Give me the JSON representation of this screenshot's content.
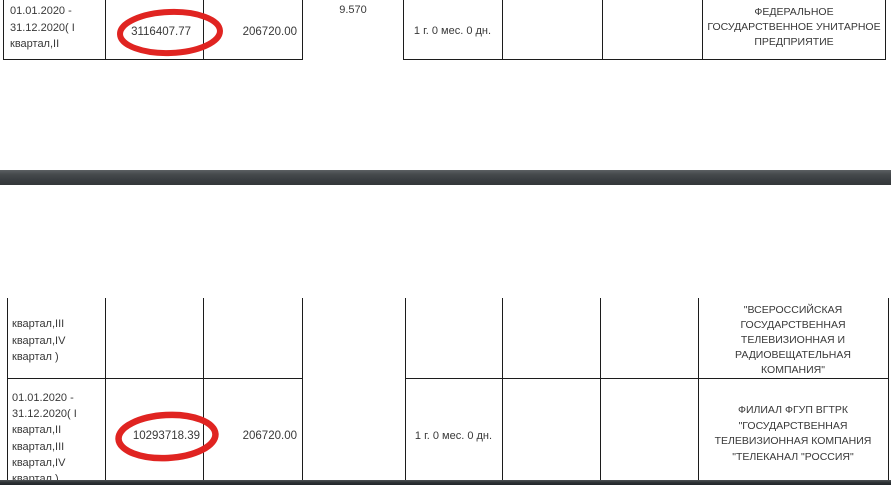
{
  "document": {
    "type": "pdf-table-fragment",
    "language": "ru"
  },
  "page1": {
    "row": {
      "period": "01.01.2020 -\n31.12.2020( I\nквартал,II",
      "max_price": "3116407.77",
      "guarantee": "206720.00",
      "rate": "9.570",
      "duration": "1 г. 0 мес. 0 дн.",
      "supplier": "ФЕДЕРАЛЬНОЕ\nГОСУДАРСТВЕННОЕ УНИТАРНОЕ\nПРЕДПРИЯТИЕ"
    }
  },
  "page2": {
    "row1": {
      "period": "квартал,III\nквартал,IV\nквартал )",
      "supplier": "\"ВСЕРОССИЙСКАЯ\nГОСУДАРСТВЕННАЯ\nТЕЛЕВИЗИОННАЯ И\nРАДИОВЕЩАТЕЛЬНАЯ\nКОМПАНИЯ\""
    },
    "row2": {
      "period": "01.01.2020 -\n31.12.2020( I\nквартал,II\nквартал,III\nквартал,IV\nквартал )",
      "max_price": "10293718.39",
      "guarantee": "206720.00",
      "duration": "1 г. 0 мес. 0 дн.",
      "supplier": "ФИЛИАЛ ФГУП ВГТРК\n\"ГОСУДАРСТВЕННАЯ\nТЕЛЕВИЗИОННАЯ КОМПАНИЯ\n\"ТЕЛЕКАНАЛ \"РОССИЯ\""
    }
  },
  "annotations": {
    "highlight_color": "#e02421",
    "circled_values": [
      "3116407.77",
      "10293718.39"
    ]
  },
  "colors": {
    "border": "#1c1c1c",
    "text": "#383838",
    "page_separator": "#3a3e41"
  }
}
